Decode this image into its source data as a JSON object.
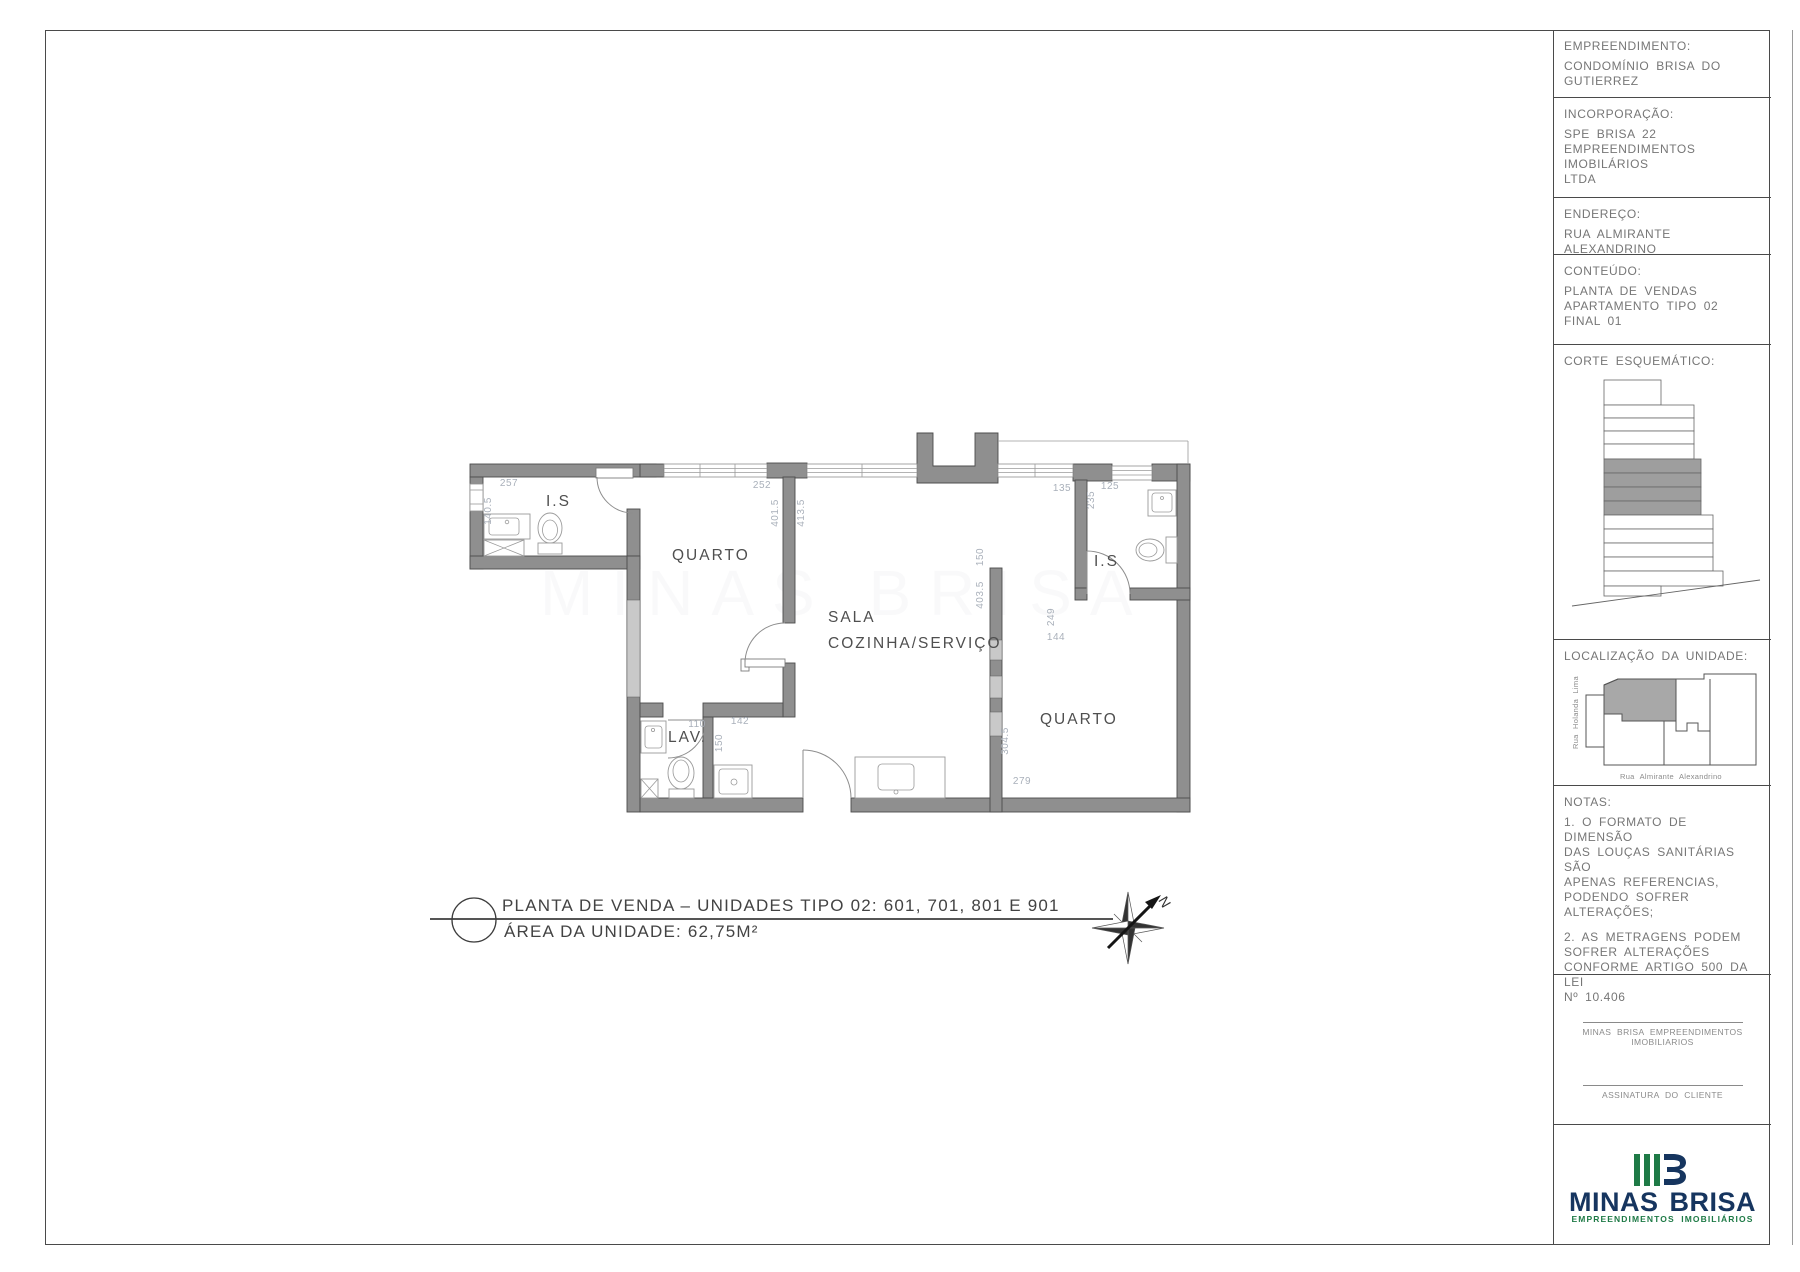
{
  "title_block": {
    "empreendimento": {
      "label": "EMPREENDIMENTO:",
      "value": "CONDOMÍNIO BRISA DO\nGUTIERREZ"
    },
    "incorporacao": {
      "label": "INCORPORAÇÃO:",
      "value": "SPE BRISA 22\nEMPREENDIMENTOS IMOBILÁRIOS\nLTDA"
    },
    "endereco": {
      "label": "ENDEREÇO:",
      "value": "RUA ALMIRANTE ALEXANDRINO"
    },
    "conteudo": {
      "label": "CONTEÚDO:",
      "value": "PLANTA DE VENDAS\nAPARTAMENTO TIPO 02\nFINAL 01"
    },
    "corte": {
      "label": "CORTE ESQUEMÁTICO:"
    },
    "localizacao": {
      "label": "LOCALIZAÇÃO DA UNIDADE:",
      "street_left": "Rua Holanda Lima",
      "street_bottom": "Rua Almirante Alexandrino"
    },
    "notas": {
      "label": "NOTAS:",
      "nota1": "1. O FORMATO DE DIMENSÃO\nDAS LOUÇAS SANITÁRIAS SÃO\nAPENAS REFERENCIAS,\nPODENDO SOFRER\nALTERAÇÕES;",
      "nota2": "2. AS METRAGENS PODEM\nSOFRER ALTERAÇÕES\nCONFORME ARTIGO 500 DA LEI\nNº 10.406"
    },
    "assinaturas": {
      "builder": "MINAS BRISA EMPREENDIMENTOS\nIMOBILIARIOS",
      "client": "ASSINATURA DO CLIENTE"
    },
    "logo": {
      "name": "MINAS BRISA",
      "tagline": "EMPREENDIMENTOS IMOBILIÁRIOS"
    }
  },
  "plan": {
    "rooms": {
      "is1": "I.S",
      "quarto1": "QUARTO",
      "sala_line1": "SALA",
      "sala_line2": "COZINHA/SERVIÇO",
      "is2": "I.S",
      "quarto2": "QUARTO",
      "lav": "LAV."
    },
    "dimensions": [
      {
        "v": "257",
        "x": 509,
        "y": 486
      },
      {
        "v": "140.5",
        "x": 491,
        "y": 511,
        "rot": -90
      },
      {
        "v": "252",
        "x": 762,
        "y": 488
      },
      {
        "v": "401.5",
        "x": 778,
        "y": 513,
        "rot": -90
      },
      {
        "v": "413.5",
        "x": 804,
        "y": 513,
        "rot": -90
      },
      {
        "v": "150",
        "x": 983,
        "y": 557,
        "rot": -90
      },
      {
        "v": "403.5",
        "x": 983,
        "y": 595,
        "rot": -90
      },
      {
        "v": "135",
        "x": 1062,
        "y": 491
      },
      {
        "v": "125",
        "x": 1110,
        "y": 489
      },
      {
        "v": "235",
        "x": 1094,
        "y": 500,
        "rot": -90
      },
      {
        "v": "249",
        "x": 1054,
        "y": 617,
        "rot": -90
      },
      {
        "v": "144",
        "x": 1056,
        "y": 640
      },
      {
        "v": "110",
        "x": 697,
        "y": 727
      },
      {
        "v": "142",
        "x": 740,
        "y": 724
      },
      {
        "v": "150",
        "x": 722,
        "y": 743,
        "rot": -90
      },
      {
        "v": "304.5",
        "x": 1008,
        "y": 741,
        "rot": -90
      },
      {
        "v": "279",
        "x": 1022,
        "y": 784
      }
    ],
    "title": {
      "line1": "PLANTA DE VENDA – UNIDADES TIPO 02: 601, 701, 801 E 901",
      "line2": "ÁREA DA UNIDADE: 62,75M²"
    },
    "north_label": "N",
    "watermark": "MINAS BRISA"
  },
  "corte_floors": [
    {
      "w": 57,
      "h": 25,
      "g": 0
    },
    {
      "w": 90,
      "h": 13,
      "g": 0
    },
    {
      "w": 90,
      "h": 13,
      "g": 0
    },
    {
      "w": 90,
      "h": 13,
      "g": 0
    },
    {
      "w": 90,
      "h": 15,
      "g": 0
    },
    {
      "w": 97,
      "h": 14,
      "g": 1
    },
    {
      "w": 97,
      "h": 14,
      "g": 1
    },
    {
      "w": 97,
      "h": 14,
      "g": 1
    },
    {
      "w": 97,
      "h": 14,
      "g": 1
    },
    {
      "w": 109,
      "h": 14,
      "g": 0
    },
    {
      "w": 109,
      "h": 14,
      "g": 0
    },
    {
      "w": 109,
      "h": 14,
      "g": 0
    },
    {
      "w": 109,
      "h": 14,
      "g": 0
    },
    {
      "w": 119,
      "h": 15,
      "g": 0
    },
    {
      "w": 57,
      "h": 10,
      "g": 0
    }
  ],
  "colors": {
    "wall": "#8f8f8f",
    "wall_light": "#c9c9c9",
    "dim_text": "#a9b0ba",
    "room_text": "#4f4f4f",
    "frame": "#4a4a4a",
    "title_block_text": "#767676",
    "logo_navy": "#16355f",
    "logo_green": "#1e7a46",
    "corte_gray": "#9e9e9e"
  }
}
